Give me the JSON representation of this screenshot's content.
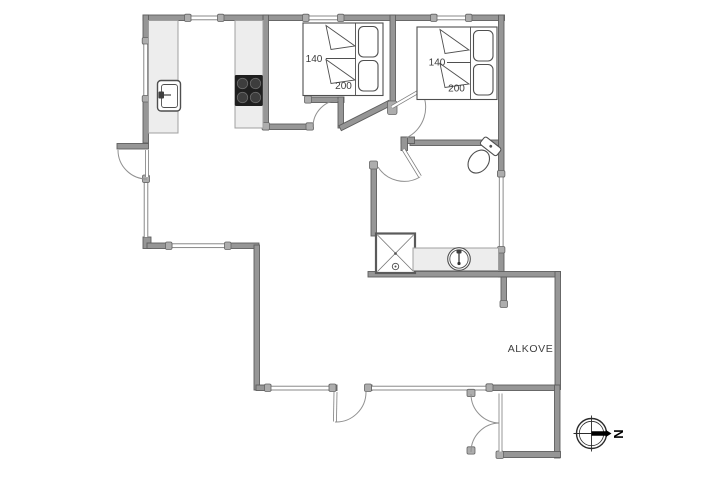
{
  "canvas": {
    "width": 718,
    "height": 479,
    "background": "#ffffff"
  },
  "legend": {
    "alkove_label": "ALKOVE",
    "compass_north_label": "N"
  },
  "bedroom1_bed": {
    "width_label": "140",
    "length_label": "200"
  },
  "bedroom2_bed": {
    "width_label": "140",
    "length_label": "200"
  },
  "colors": {
    "wall_fill": "#969696",
    "wall_edge": "#5e5e5e",
    "counter_fill": "#ededed",
    "counter_edge": "#a0a0a0",
    "fixture_line": "#4f4f4f",
    "stove_fill": "#1f1f1f",
    "door_arc": "#909090",
    "label_text": "#3c3c3c"
  }
}
